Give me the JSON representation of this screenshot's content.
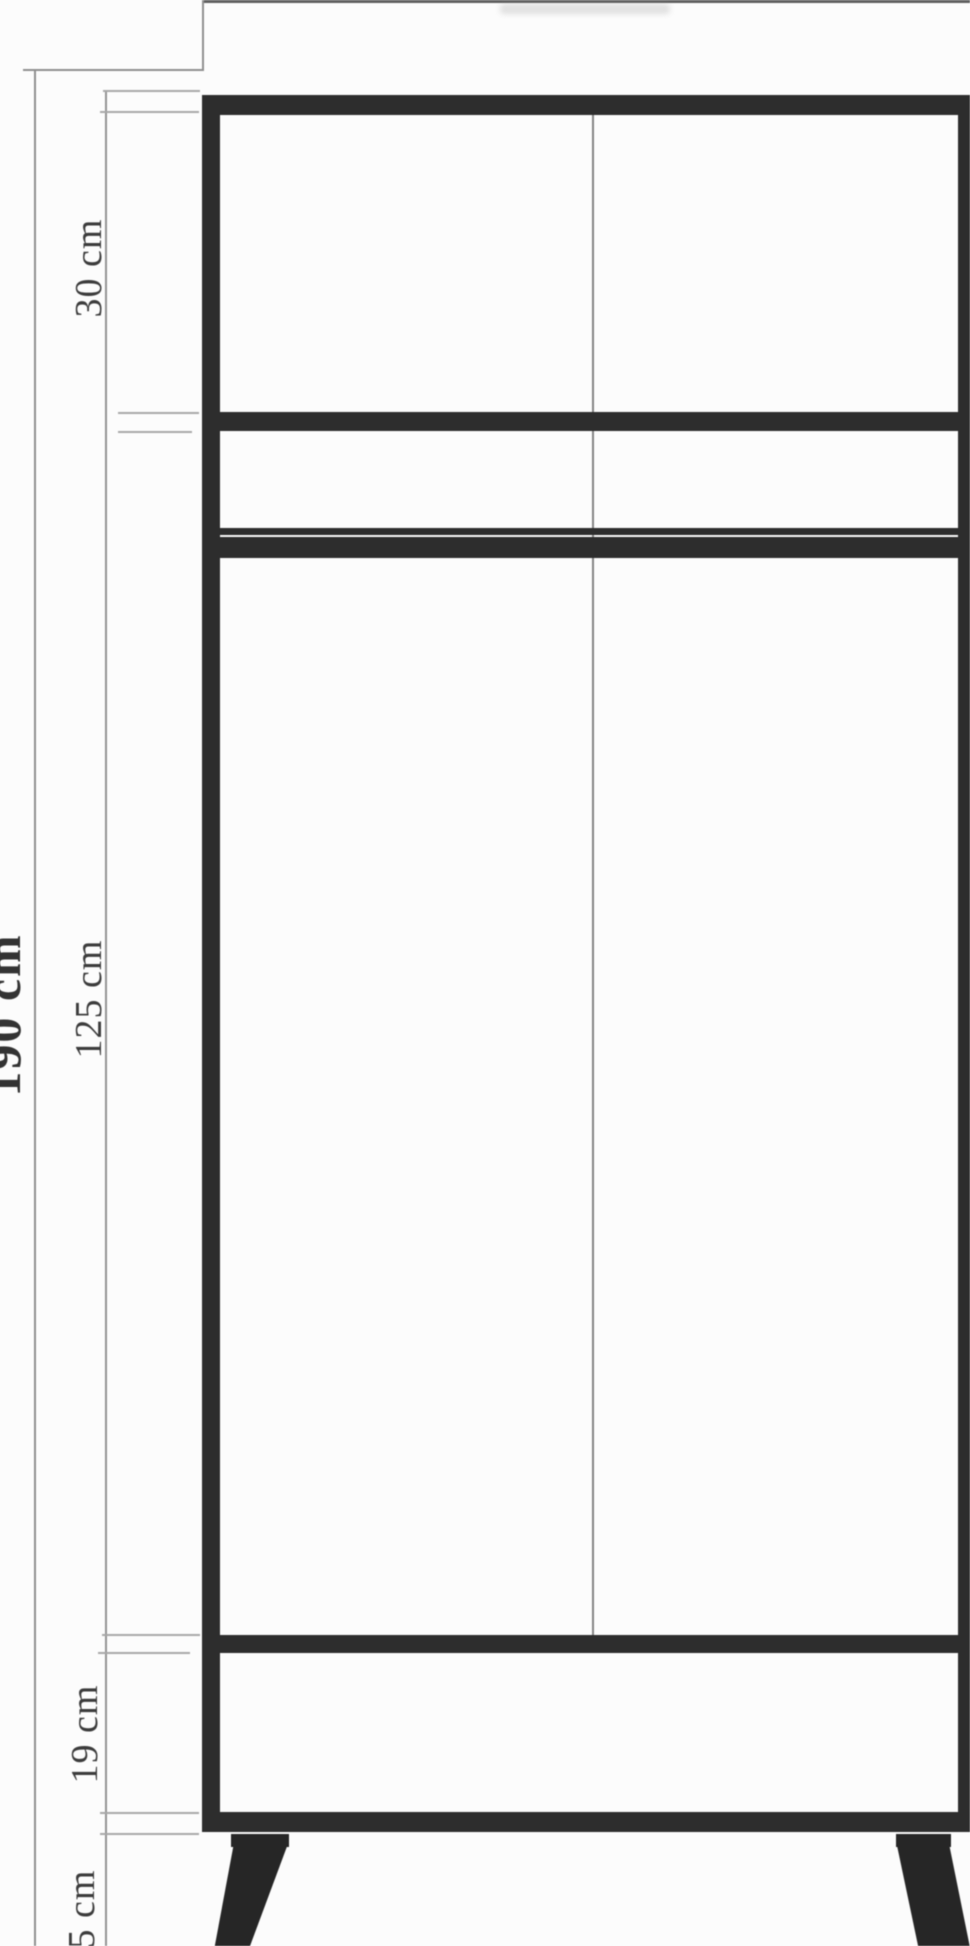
{
  "diagram": {
    "subject": "two-door wardrobe front elevation with dimension lines",
    "unit": "cm",
    "dimension_labels": {
      "total_height": "190 cm",
      "top_compartment": "30 cm",
      "middle_compartment": "125 cm",
      "drawer_compartment": "19 cm",
      "legs": "5 cm"
    },
    "dimensions": [
      {
        "name": "total height",
        "label": "190 cm",
        "value_cm": 190
      },
      {
        "name": "top shelf compartment height",
        "label": "30 cm",
        "value_cm": 30
      },
      {
        "name": "hanging compartment height",
        "label": "125 cm",
        "value_cm": 125
      },
      {
        "name": "drawer section height",
        "label": "19 cm",
        "value_cm": 19
      },
      {
        "name": "leg height",
        "label": "5 cm",
        "value_cm": 5
      }
    ],
    "colors": {
      "structure": "#2d2d2d",
      "legs": "#262626",
      "dimension_lines": "#909090",
      "extension_ticks": "#a8a8a8",
      "door_divider": "#848484",
      "text": "#3c3c3c",
      "background": "#fcfcfc"
    }
  }
}
